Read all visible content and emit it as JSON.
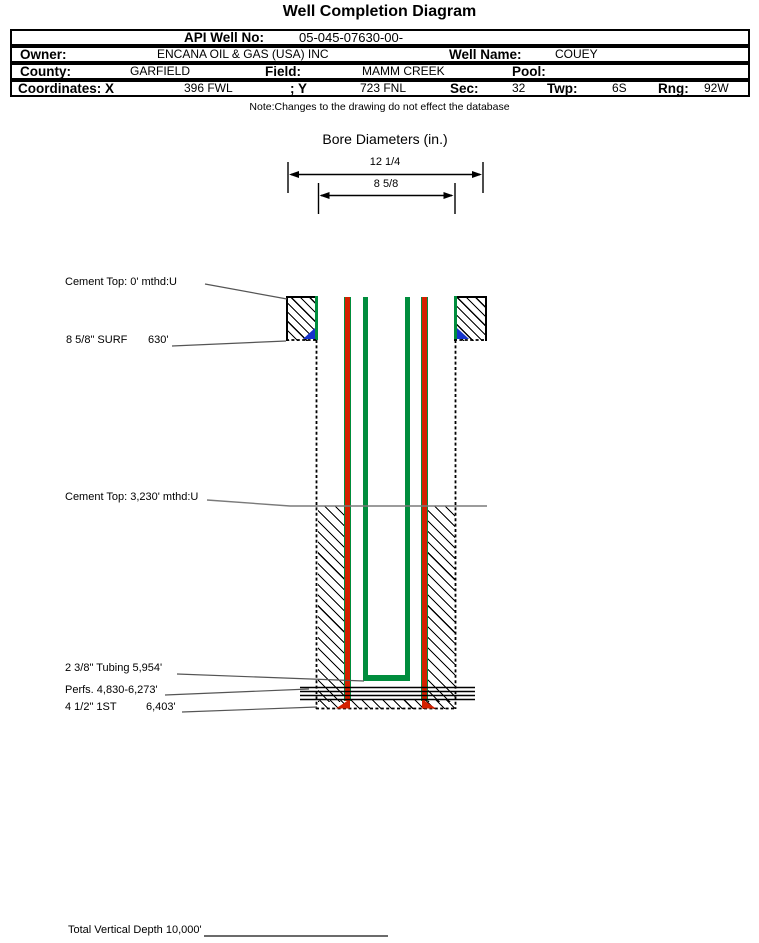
{
  "title": "Well Completion Diagram",
  "header": {
    "api_label": "API Well No:",
    "api_value": "05-045-07630-00-",
    "owner_label": "Owner:",
    "owner_value": "ENCANA OIL & GAS (USA) INC",
    "well_name_label": "Well Name:",
    "well_name_value": "COUEY",
    "county_label": "County:",
    "county_value": "GARFIELD",
    "field_label": "Field:",
    "field_value": "MAMM CREEK",
    "pool_label": "Pool:",
    "pool_value": "",
    "coordinates_label": "Coordinates: X",
    "x_value": "396 FWL",
    "y_label": "; Y",
    "y_value": "723 FNL",
    "sec_label": "Sec:",
    "sec_value": "32",
    "twp_label": "Twp:",
    "twp_value": "6S",
    "rng_label": "Rng:",
    "rng_value": "92W"
  },
  "note": "Note:Changes to the drawing do not effect the database",
  "bore_diameters": {
    "title": "Bore Diameters (in.)",
    "outer_diameter": "12 1/4",
    "inner_diameter": "8 5/8"
  },
  "annotations": {
    "cement_top_surface": "Cement Top: 0' mthd:U",
    "surface_casing": "8 5/8\" SURF",
    "surface_casing_depth": "630'",
    "cement_top_production": "Cement Top: 3,230' mthd:U",
    "tubing": "2 3/8\" Tubing 5,954'",
    "perforations": "Perfs. 4,830-6,273'",
    "production_casing": "4 1/2\" 1ST",
    "production_casing_depth": "6,403'",
    "total_depth": "Total Vertical Depth 10,000'"
  },
  "colors": {
    "casing_green": "#008D3D",
    "casing_red": "#D42000",
    "cement_shoe_blue": "#1433CC",
    "hatch_black": "#000000"
  }
}
